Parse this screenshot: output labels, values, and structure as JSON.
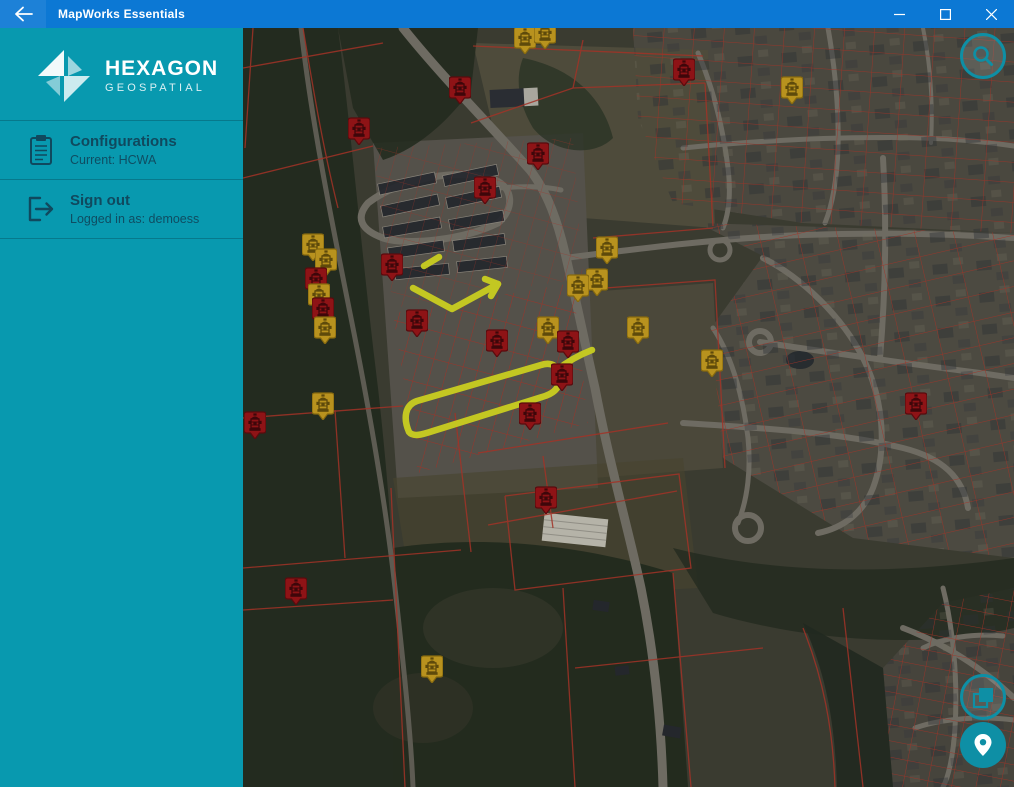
{
  "titlebar": {
    "title": "MapWorks Essentials"
  },
  "sidebar": {
    "brand": {
      "name": "HEXAGON",
      "subname": "GEOSPATIAL"
    },
    "items": [
      {
        "label": "Configurations",
        "sublabel": "Current: HCWA",
        "icon": "clipboard-icon"
      },
      {
        "label": "Sign out",
        "sublabel": "Logged in as: demoess",
        "icon": "sign-out-icon"
      }
    ]
  },
  "map": {
    "icons": {
      "search": "magnifier",
      "basemap": "layers",
      "locate": "map-pin",
      "markers": "fire-hydrant"
    },
    "markers": [
      {
        "type": "yellow",
        "x": 282,
        "y": 12
      },
      {
        "type": "yellow",
        "x": 302,
        "y": 7
      },
      {
        "type": "red",
        "x": 217,
        "y": 62
      },
      {
        "type": "red",
        "x": 441,
        "y": 44
      },
      {
        "type": "yellow",
        "x": 549,
        "y": 62
      },
      {
        "type": "red",
        "x": 116,
        "y": 103
      },
      {
        "type": "red",
        "x": 295,
        "y": 128
      },
      {
        "type": "red",
        "x": 242,
        "y": 162
      },
      {
        "type": "yellow",
        "x": 70,
        "y": 219
      },
      {
        "type": "yellow",
        "x": 364,
        "y": 222
      },
      {
        "type": "yellow",
        "x": 83,
        "y": 234
      },
      {
        "type": "red",
        "x": 149,
        "y": 239
      },
      {
        "type": "red",
        "x": 73,
        "y": 253
      },
      {
        "type": "yellow",
        "x": 354,
        "y": 254
      },
      {
        "type": "yellow",
        "x": 335,
        "y": 260
      },
      {
        "type": "yellow",
        "x": 76,
        "y": 269
      },
      {
        "type": "red",
        "x": 80,
        "y": 283
      },
      {
        "type": "red",
        "x": 174,
        "y": 295
      },
      {
        "type": "yellow",
        "x": 82,
        "y": 302
      },
      {
        "type": "yellow",
        "x": 305,
        "y": 302
      },
      {
        "type": "yellow",
        "x": 395,
        "y": 302
      },
      {
        "type": "red",
        "x": 254,
        "y": 315
      },
      {
        "type": "red",
        "x": 325,
        "y": 316
      },
      {
        "type": "yellow",
        "x": 469,
        "y": 335
      },
      {
        "type": "red",
        "x": 319,
        "y": 349
      },
      {
        "type": "red",
        "x": 673,
        "y": 378
      },
      {
        "type": "yellow",
        "x": 80,
        "y": 378
      },
      {
        "type": "red",
        "x": 287,
        "y": 388
      },
      {
        "type": "red",
        "x": 12,
        "y": 397
      },
      {
        "type": "red",
        "x": 303,
        "y": 472
      },
      {
        "type": "red",
        "x": 53,
        "y": 563
      },
      {
        "type": "yellow",
        "x": 189,
        "y": 641
      }
    ]
  },
  "theme": {
    "--titlebar-blue": "#0C78D4",
    "--sidebar-teal": "#0899AF",
    "--sidebar-text": "#10495E",
    "--marker-red": "#8E1316",
    "--marker-red-border": "#5A0B0E",
    "--marker-yellow": "#B8921E",
    "--marker-yellow-border": "#86690F",
    "--parcel-red": "#A23227",
    "--route-yellow": "#C9CE20",
    "--ui-teal": "#0E8FA5",
    "--map-base": "#3A3B30"
  }
}
